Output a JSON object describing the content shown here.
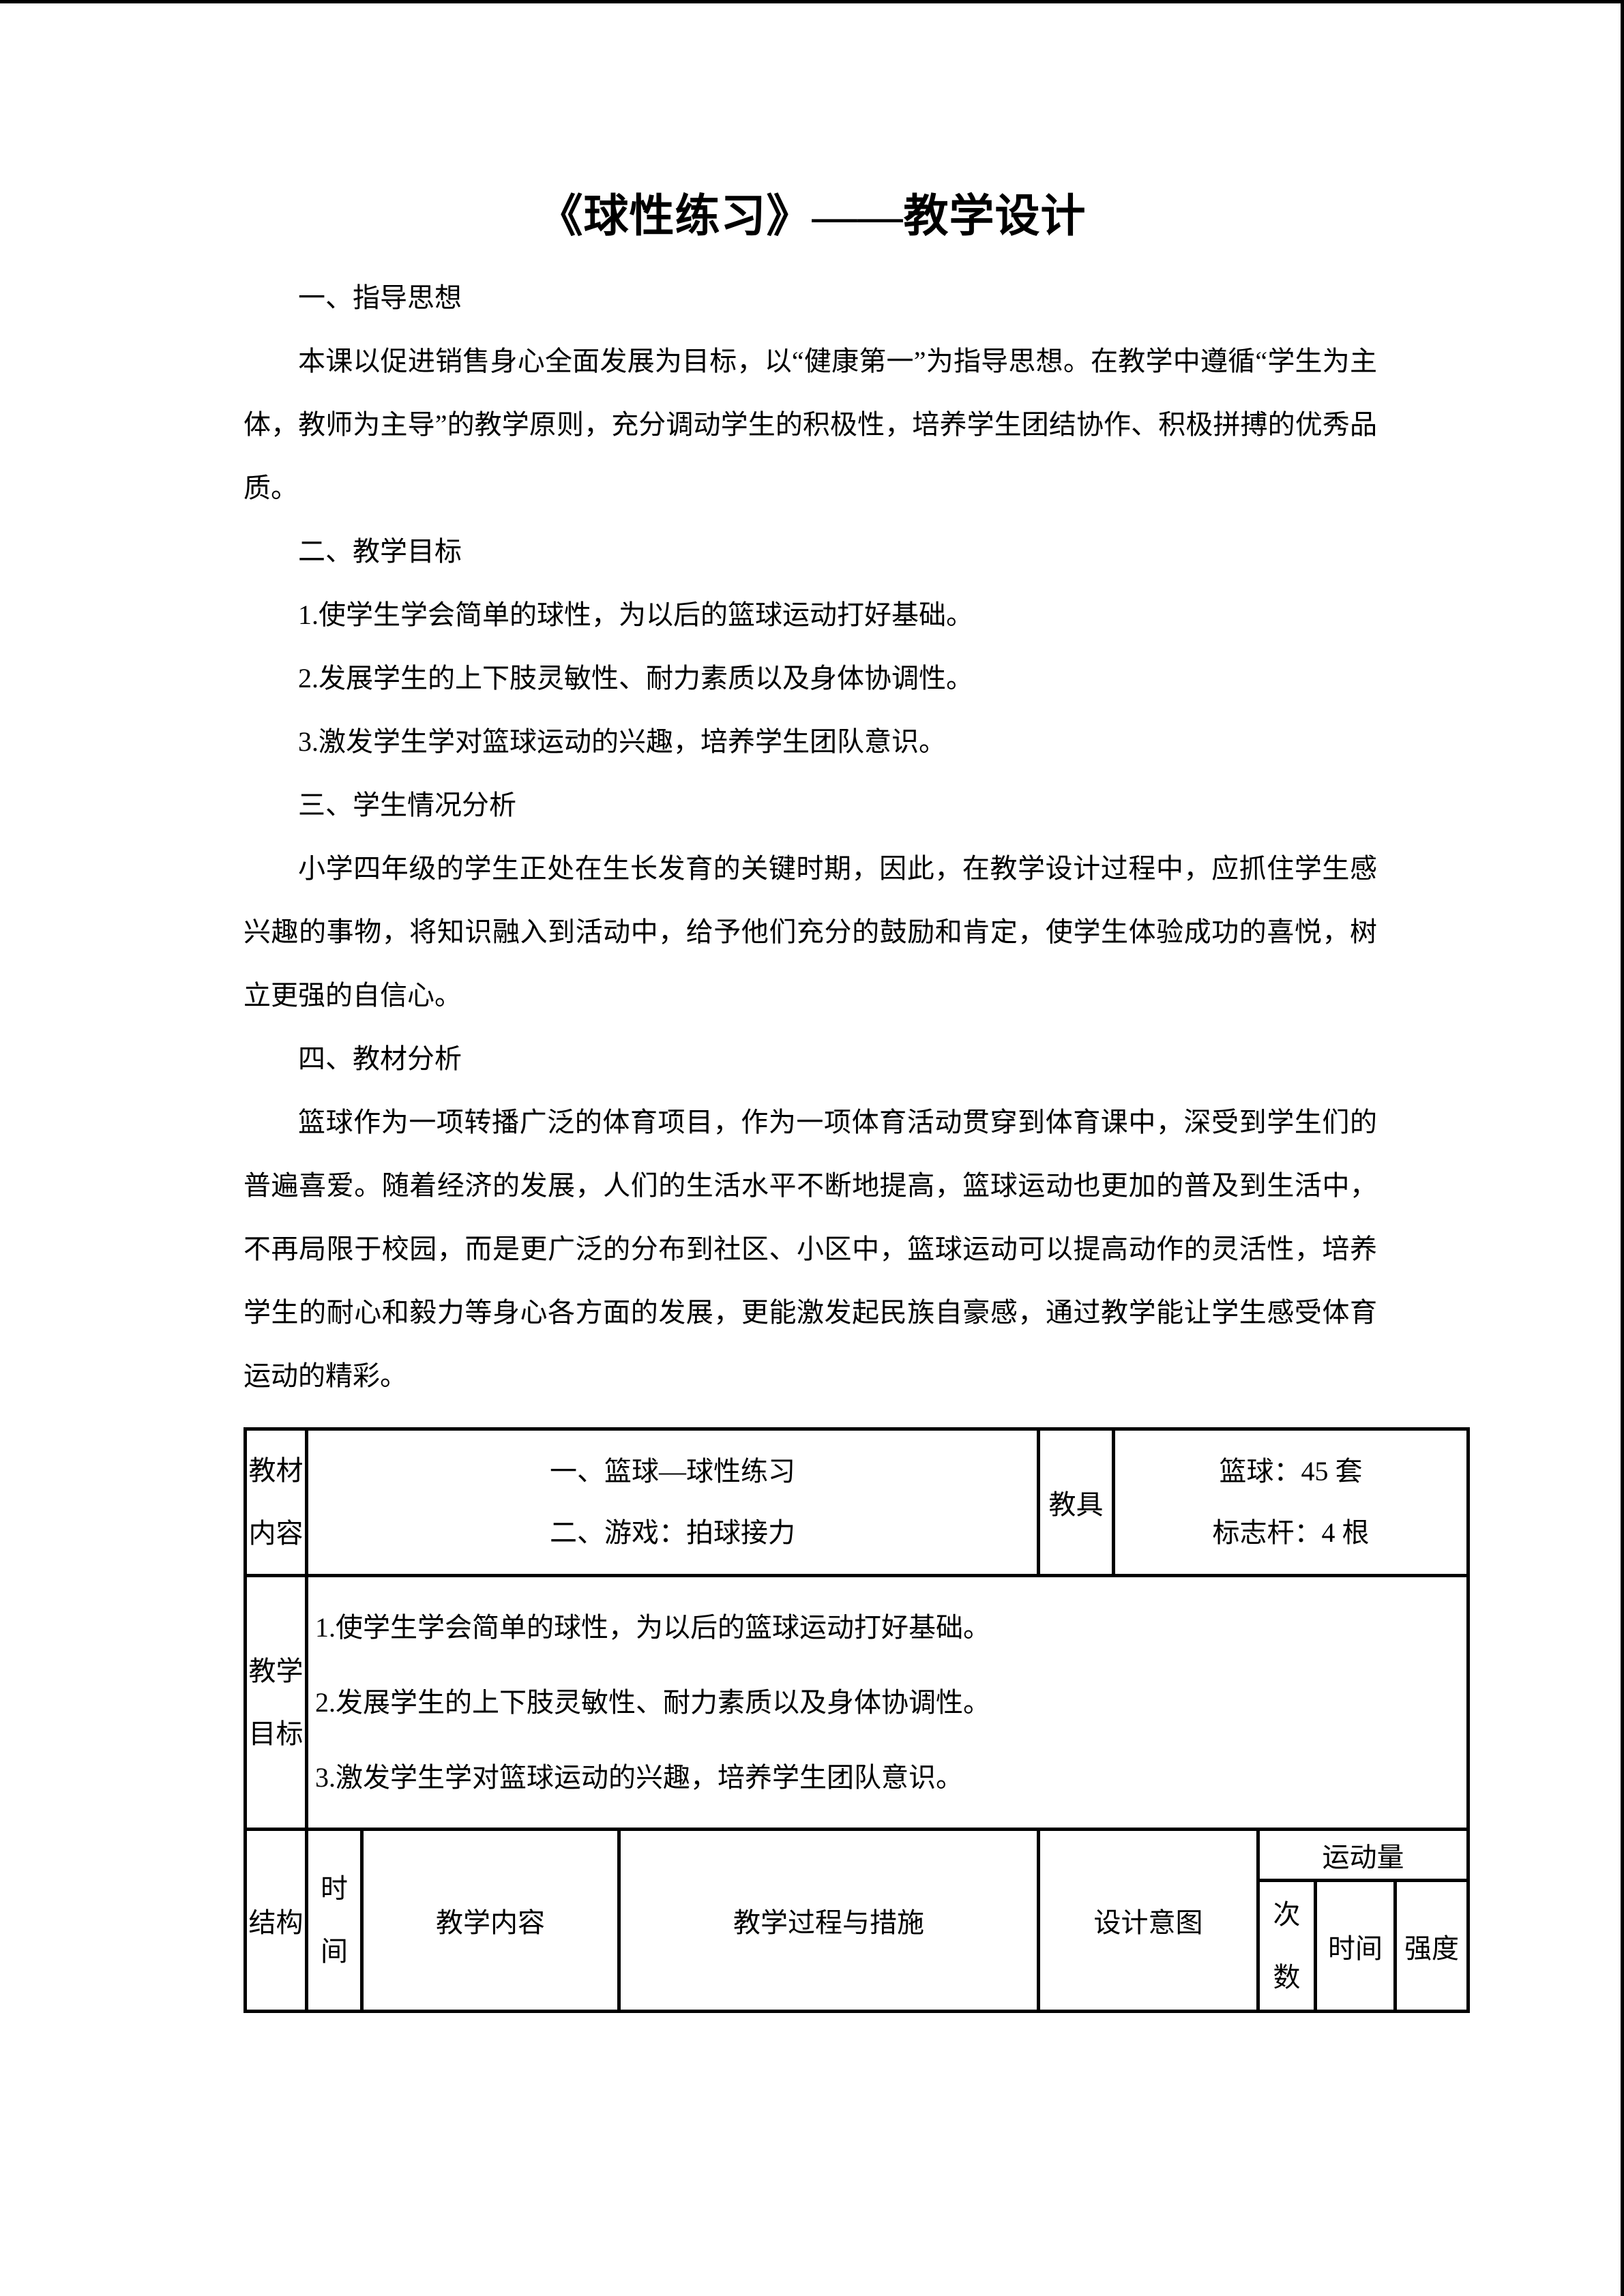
{
  "page": {
    "title": "《球性练习》——教学设计"
  },
  "body": {
    "sections": [
      {
        "heading": "一、指导思想",
        "paragraphs": [
          "本课以促进销售身心全面发展为目标，以“健康第一”为指导思想。在教学中遵循“学生为主体，教师为主导”的教学原则，充分调动学生的积极性，培养学生团结协作、积极拼搏的优秀品质。"
        ]
      },
      {
        "heading": "二、教学目标",
        "paragraphs": [
          "1.使学生学会简单的球性，为以后的篮球运动打好基础。",
          "2.发展学生的上下肢灵敏性、耐力素质以及身体协调性。",
          "3.激发学生学对篮球运动的兴趣，培养学生团队意识。"
        ]
      },
      {
        "heading": "三、学生情况分析",
        "paragraphs": [
          "小学四年级的学生正处在生长发育的关键时期，因此，在教学设计过程中，应抓住学生感兴趣的事物，将知识融入到活动中，给予他们充分的鼓励和肯定，使学生体验成功的喜悦，树立更强的自信心。"
        ]
      },
      {
        "heading": "四、教材分析",
        "paragraphs": [
          "篮球作为一项转播广泛的体育项目，作为一项体育活动贯穿到体育课中，深受到学生们的普遍喜爱。随着经济的发展，人们的生活水平不断地提高，篮球运动也更加的普及到生活中，不再局限于校园，而是更广泛的分布到社区、小区中，篮球运动可以提高动作的灵活性，培养学生的耐心和毅力等身心各方面的发展，更能激发起民族自豪感，通过教学能让学生感受体育运动的精彩。"
        ]
      }
    ]
  },
  "table": {
    "row1": {
      "label": [
        "教材",
        "内容"
      ],
      "content": [
        "一、篮球—球性练习",
        "二、游戏：拍球接力"
      ],
      "aids_label": "教具",
      "aids": [
        "篮球：45 套",
        "标志杆：4 根"
      ]
    },
    "row2": {
      "label": [
        "教学",
        "目标"
      ],
      "goals": [
        "1.使学生学会简单的球性，为以后的篮球运动打好基础。",
        "2.发展学生的上下肢灵敏性、耐力素质以及身体协调性。",
        "3.激发学生学对篮球运动的兴趣，培养学生团队意识。"
      ]
    },
    "row3": {
      "structure": "结构",
      "time": [
        "时",
        "间"
      ],
      "teaching_content": "教学内容",
      "process": "教学过程与措施",
      "intent": "设计意图",
      "exercise_load": "运动量",
      "times": [
        "次",
        "数"
      ],
      "time2": "时间",
      "intensity": "强度"
    }
  },
  "colors": {
    "text": "#000000",
    "background": "#ffffff",
    "border": "#000000"
  }
}
